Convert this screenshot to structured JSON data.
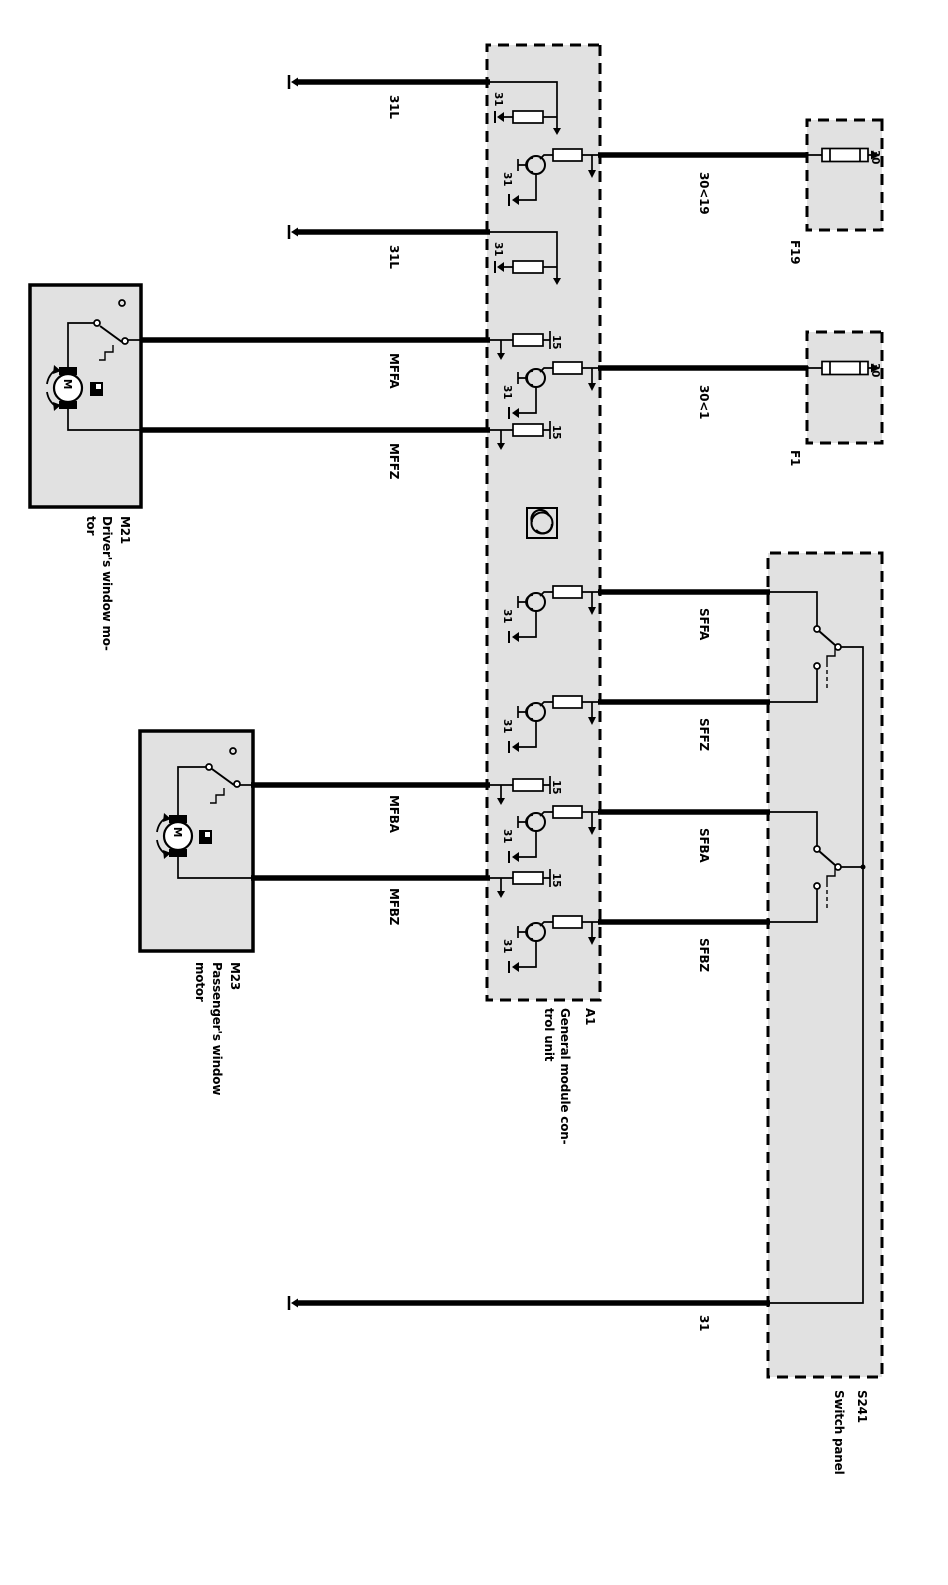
{
  "colors": {
    "box_fill": "#e1e1e1",
    "line": "#000000",
    "page_bg": "#ffffff"
  },
  "boxes": {
    "a1": {
      "id": "A1",
      "name1": "General module con-",
      "name2": "trol unit"
    },
    "f19": {
      "id": "F19"
    },
    "f1": {
      "id": "F1"
    },
    "s241": {
      "id": "S241",
      "name1": "Switch panel"
    },
    "m21": {
      "id": "M21",
      "name1": "Driver's window mo-",
      "name2": "tor"
    },
    "m23": {
      "id": "M23",
      "name1": "Passenger's window",
      "name2": "motor"
    }
  },
  "pins": {
    "ground": "31",
    "ignition": "15",
    "battery": "30"
  },
  "motor_letter": "M",
  "wires": {
    "ground_link_a": "31L",
    "ground_link_b": "31L",
    "mffa": "MFFA",
    "mffz": "MFFZ",
    "mfba": "MFBA",
    "mfbz": "MFBZ",
    "to_f19": "30<19",
    "to_f1": "30<1",
    "sffa": "SFFA",
    "sffz": "SFFZ",
    "sfba": "SFBA",
    "sfbz": "SFBZ",
    "ground": "31"
  }
}
